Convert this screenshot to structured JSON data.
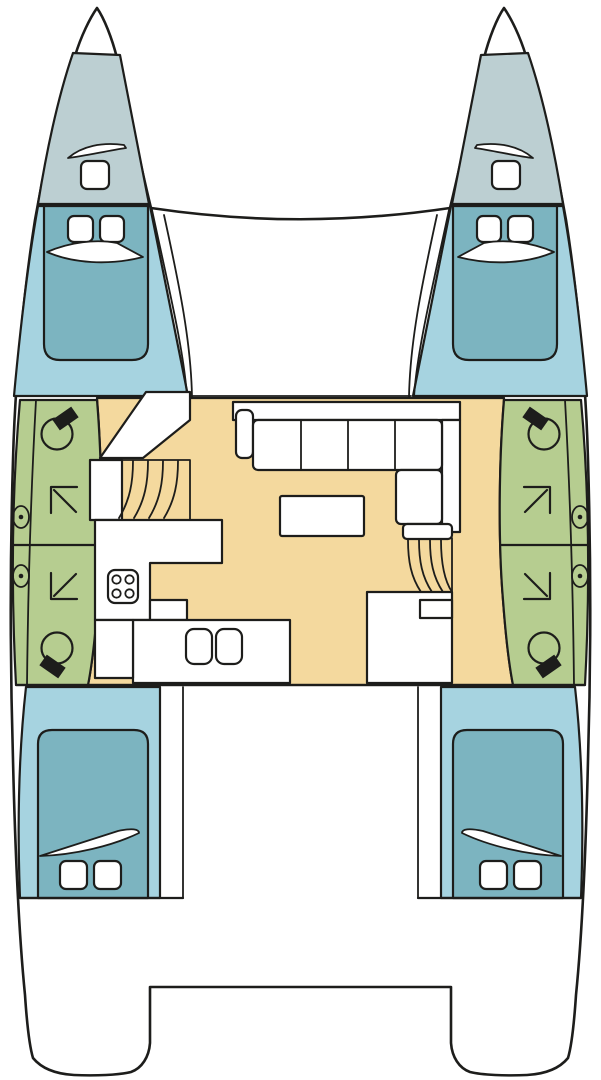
{
  "page": {
    "width": 601,
    "height": 1080
  },
  "diagram": {
    "kind": "catamaran-deck-plan",
    "orientation": "bow-up",
    "hulls": 2
  },
  "colors": {
    "background": "#ffffff",
    "line": "#1d1d1b",
    "hull": "#ffffff",
    "foredeck": "#bccfd2",
    "cabin_floor": "#a6d3e0",
    "berth": "#7cb4c0",
    "bathroom": "#b6cd90",
    "saloon_floor": "#f4d99e",
    "furniture": "#ffffff"
  },
  "rooms": {
    "port_hull": [
      "bow locker",
      "forward double cabin",
      "forward shower-wc",
      "aft shower-wc",
      "aft double cabin"
    ],
    "starboard_hull": [
      "bow locker",
      "forward double cabin",
      "forward shower-wc",
      "aft shower-wc",
      "aft double cabin"
    ],
    "center": [
      "foredeck trampoline",
      "saloon with L-settee and table",
      "galley with stove and double sink",
      "port companionway stairs",
      "starboard companionway stairs",
      "aft platform"
    ]
  },
  "features": {
    "berths": 4,
    "toilets": 4,
    "shower_compartments": 4,
    "portholes": 4,
    "deck_hatches": 10,
    "stove_burners": 4,
    "sink_bowls": 2,
    "settee_cushions": 5
  }
}
